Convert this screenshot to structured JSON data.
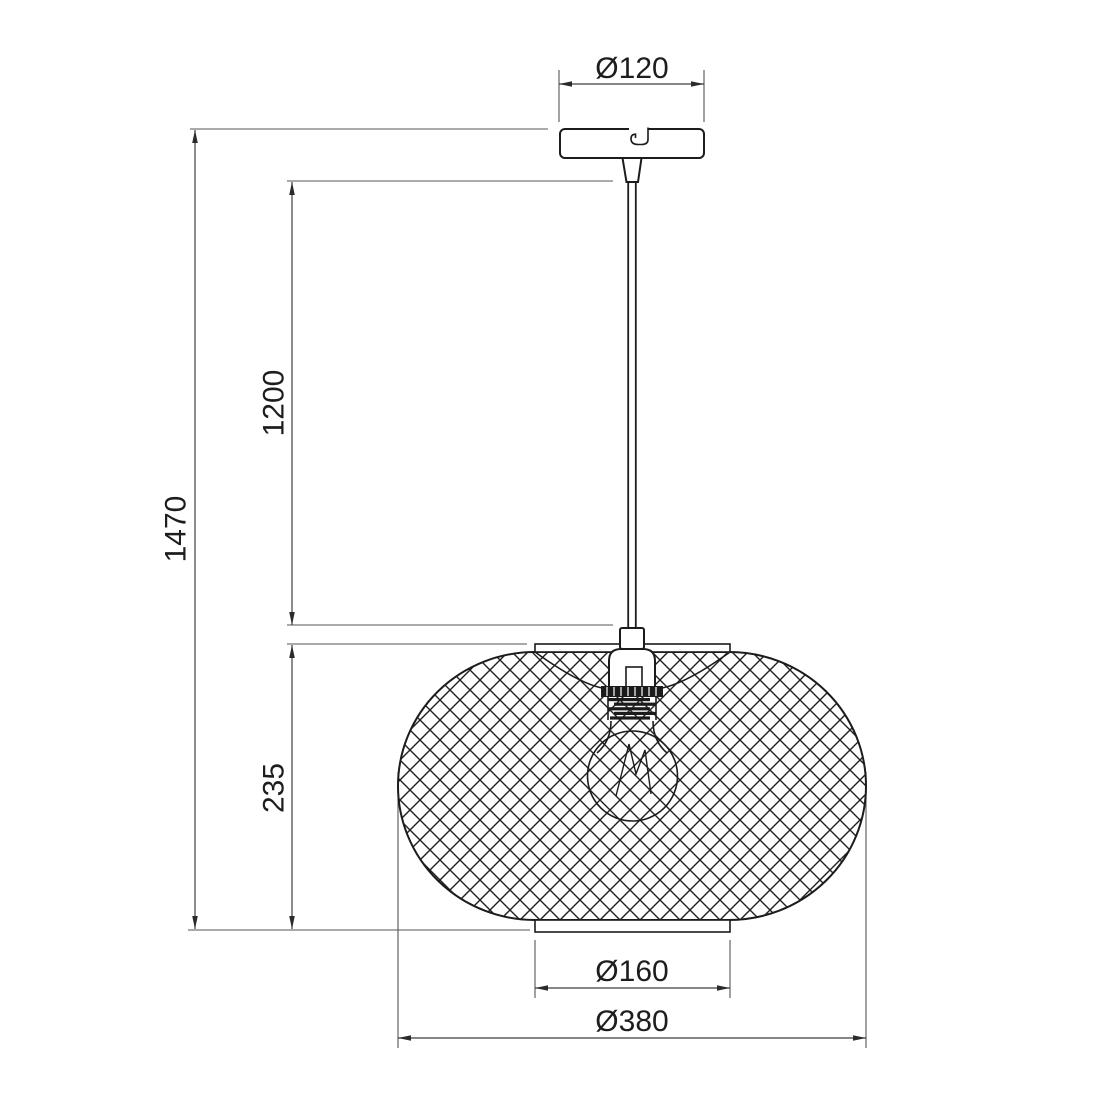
{
  "drawing": {
    "title": "pendant-lamp-dimension-drawing",
    "background_color": "#ffffff",
    "object_line_color": "#1c1c1c",
    "dimension_line_color": "#3f3f3f"
  },
  "dimensions": {
    "canopy_diameter": {
      "label": "Ø120",
      "value_mm": 120,
      "orientation": "horizontal"
    },
    "overall_drop": {
      "label": "1470",
      "value_mm": 1470,
      "orientation": "vertical"
    },
    "suspension_length": {
      "label": "1200",
      "value_mm": 1200,
      "orientation": "vertical"
    },
    "shade_height": {
      "label": "235",
      "value_mm": 235,
      "orientation": "vertical"
    },
    "opening_diameter": {
      "label": "Ø160",
      "value_mm": 160,
      "orientation": "horizontal"
    },
    "shade_diameter": {
      "label": "Ø380",
      "value_mm": 380,
      "orientation": "horizontal"
    }
  },
  "components": [
    "ceiling-canopy",
    "strain-relief",
    "suspension-rod",
    "socket-cap",
    "knurled-ring",
    "screw-thread",
    "light-bulb",
    "filament",
    "mesh-shade",
    "top-collar",
    "bottom-collar"
  ]
}
